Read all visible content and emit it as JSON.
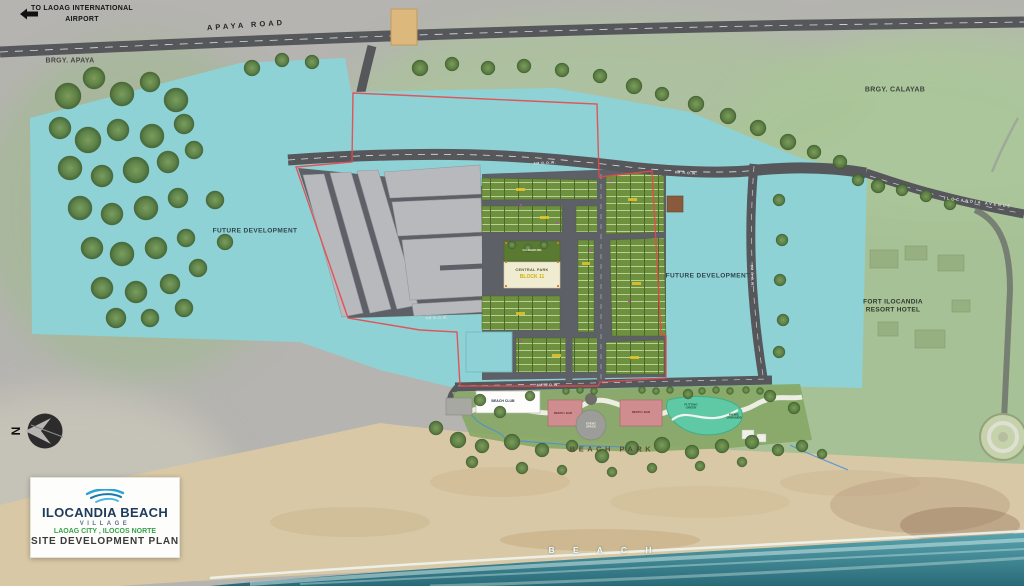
{
  "map": {
    "airport_note_line1": "TO LAOAG INTERNATIONAL",
    "airport_note_line2": "AIRPORT",
    "roads": {
      "apaya": "APAYA ROAD",
      "ilocandia_avenue": "ILOCANDIA AVENUE",
      "row_6m": "6M R.O.W."
    },
    "areas": {
      "brgy_apaya": "BRGY. APAYA",
      "brgy_calayab": "BRGY. CALAYAB",
      "future_development": "FUTURE DEVELOPMENT",
      "fort_line1": "FORT ILOCANDIA",
      "fort_line2": "RESORT HOTEL",
      "clubhouse": "CLUBHOUSE",
      "central_park": "CENTRAL PARK",
      "central_park_block": "BLOCK 11",
      "beach_club": "BEACH CLUB",
      "resto_bar": "RESTO / BAR",
      "event_space": "EVENT SPACE",
      "putting_green": "PUTTING GREEN",
      "picnic_grounds": "PICNIC GROUNDS",
      "beach_park": "BEACH PARK",
      "beach": "B E A C H"
    },
    "compass_label": "N"
  },
  "legend": {
    "title": "ILOCANDIA BEACH",
    "subtitle": "VILLAGE",
    "location": "LAOAG CITY , ILOCOS NORTE",
    "plan_title": "SITE DEVELOPMENT PLAN"
  },
  "colors": {
    "site_teal": "#8ed2d6",
    "lot_green": "#6e9140",
    "boundary_red": "#e8474b",
    "road_gray": "#5d6066",
    "sand": "#d9c8a5",
    "ocean_dark": "#2a6a78",
    "brand_navy": "#1d3b5a",
    "brand_green": "#35a24a",
    "wave_blue": "#2ba3d8",
    "park_cream": "#efecd2",
    "resto_pink": "#d08d90",
    "putting_teal": "#5ec9a4"
  }
}
